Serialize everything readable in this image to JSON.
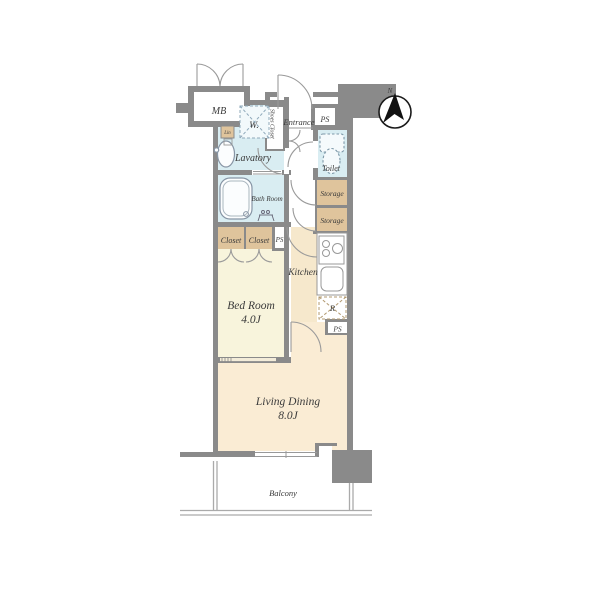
{
  "compass": {
    "north_label": "N"
  },
  "rooms": {
    "mb": "MB",
    "washer": "W.",
    "shoes_closet": "Shoes Closet",
    "entrance": "Entrance",
    "ps_entrance": "PS",
    "toilet": "Toilet",
    "storage_upper": "Storage",
    "storage_lower": "Storage",
    "lavatory": "Lavatory",
    "linen": "Lin",
    "bath": "Bath Room",
    "closet_left": "Closet",
    "closet_right": "Closet",
    "ps_closet": "PS",
    "kitchen": "Kitchen",
    "refrigerator": "R",
    "ps_kitchen": "PS",
    "bedroom": {
      "name": "Bed Room",
      "size": "4.0J"
    },
    "living_dining": {
      "name": "Living Dining",
      "size": "8.0J"
    },
    "balcony": "Balcony"
  },
  "colors": {
    "wall": "#8a8a8a",
    "wet_area": "#d9edf2",
    "storage": "#dfc49c",
    "bedroom": "#f8f4dc",
    "kitchen": "#f6e8cc",
    "living": "#faecd4"
  }
}
